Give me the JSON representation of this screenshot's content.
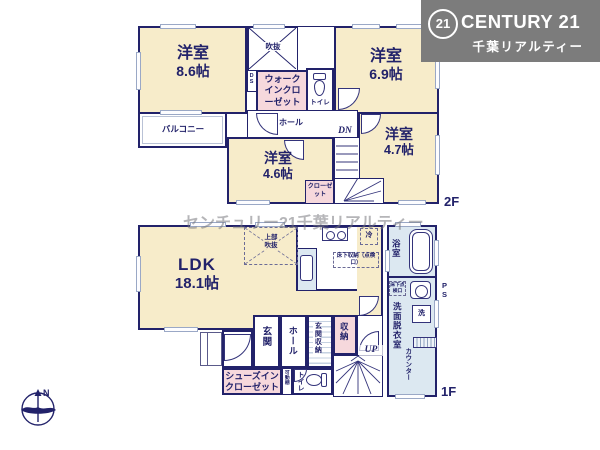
{
  "banner": {
    "logo_number": "21",
    "brand": "CENTURY 21",
    "company": "千葉リアルティー"
  },
  "watermark": "センチュリー21千葉リアルティー",
  "compass": {
    "north_label": "N"
  },
  "colors": {
    "wall": "#22226a",
    "room_fill": "#f7ecca",
    "closet_fill": "#f6d8dc",
    "wet_fill": "#dce8f1",
    "banner_bg": "#7c7c7c"
  },
  "floor2": {
    "floor_label": "2F",
    "room_86_name": "洋室",
    "room_86_size": "8.6帖",
    "room_69_name": "洋室",
    "room_69_size": "6.9帖",
    "room_47_name": "洋室",
    "room_47_size": "4.7帖",
    "room_46_name": "洋室",
    "room_46_size": "4.6帖",
    "balcony": "バルコニー",
    "void": "吹抜",
    "duct": "DS",
    "wic": "ウォークインクローゼット",
    "toilet": "トイレ",
    "hall": "ホール",
    "closet": "クローゼット",
    "stairs_dn": "DN"
  },
  "floor1": {
    "floor_label": "1F",
    "ldk_name": "LDK",
    "ldk_size": "18.1帖",
    "upper_void": "上部吹抜",
    "fridge": "冷",
    "underfloor_storage": "床下収納（点検口）",
    "underfloor_hatch": "床下点検口",
    "bath": "浴室",
    "washroom": "洗面脱衣室",
    "washer": "洗",
    "counter": "カウンター",
    "pipe_space": "PS",
    "entrance": "玄関",
    "hall": "ホール",
    "entrance_storage": "玄関収納",
    "storage": "収納",
    "shoes_closet": "シューズインクローゼット",
    "movable_shelf": "可動棚",
    "toilet": "トイレ",
    "stairs_up": "UP"
  }
}
